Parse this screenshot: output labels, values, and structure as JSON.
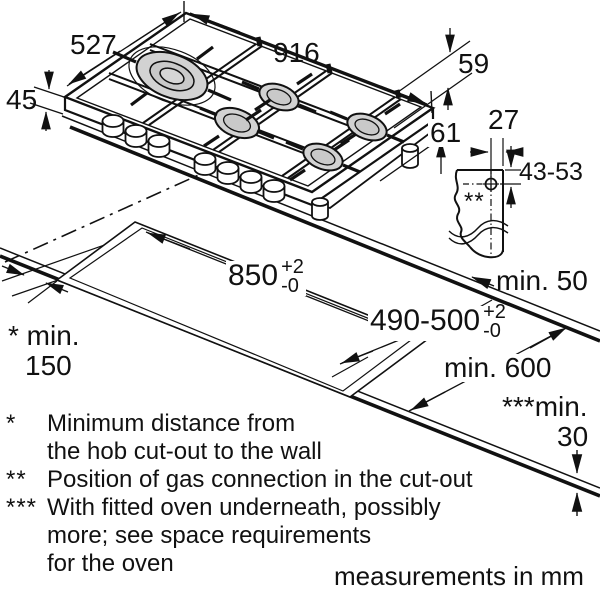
{
  "labels": {
    "hob_width": "916",
    "hob_depth": "527",
    "hob_height": "45",
    "hob_below_top": "59",
    "hob_below_total": "61",
    "gas_offset": "27",
    "gas_depth_range": "43-53",
    "gas_marker": "**",
    "cutout_length": "850",
    "cutout_length_tol_plus": "+2",
    "cutout_length_tol_minus": "-0",
    "cutout_depth": "490-500",
    "cutout_depth_tol_plus": "+2",
    "cutout_depth_tol_minus": "-0",
    "rear_clearance": "min. 50",
    "front_depth": "min. 600",
    "side_clearance_line1": "* min.",
    "side_clearance_line2": "150",
    "worktop_thickness_line1": "***min.",
    "worktop_thickness_line2": "30"
  },
  "footnote_lines": [
    {
      "marker": "*",
      "text": "Minimum distance from"
    },
    {
      "marker": "",
      "text": "the hob cut-out to the wall"
    },
    {
      "marker": "**",
      "text": "Position of gas connection in the cut-out"
    },
    {
      "marker": "***",
      "text": "With fitted oven underneath, possibly"
    },
    {
      "marker": "",
      "text": "more; see space requirements"
    },
    {
      "marker": "",
      "text": "for the oven"
    }
  ],
  "footer": {
    "note": "measurements in mm"
  },
  "colors": {
    "line": "#111111",
    "burner_gray": "#d2d2d2",
    "burner_gray2": "#c9c9c9"
  }
}
